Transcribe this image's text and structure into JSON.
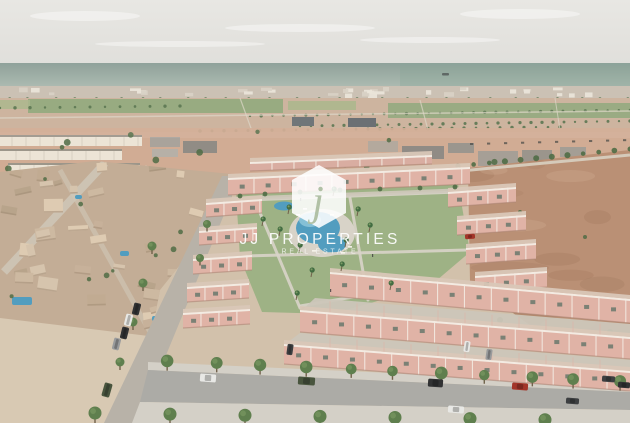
{
  "image": {
    "type": "aerial-3d-render",
    "description": "Aerial drone-style 3D render of a new-build residential development of salmon-pink villas arranged around a communal pool and landscaped gardens, next to an existing beige low-rise neighborhood on the left, a large empty dirt plot on the right, tree-lined streets with parked cars in the foreground, farm fields, a coastal town strip and the sea on the horizon under a hazy pale sky.",
    "width_px": 630,
    "height_px": 423
  },
  "watermark": {
    "brand": "JJ PROPERTIES",
    "tagline": "REAL ESTATE",
    "logo_glyph": "j",
    "logo_shape": "hexagon"
  },
  "scene": {
    "regions": [
      "sky",
      "sea",
      "ship",
      "coastal town",
      "farm fields",
      "distant buildings",
      "existing neighborhood",
      "private pools",
      "new development",
      "communal pool",
      "sun deck",
      "gardens",
      "palm trees",
      "empty dirt plot",
      "streets",
      "sidewalks",
      "street trees",
      "parked cars"
    ]
  },
  "palette": {
    "sky_top": "#e8e7e3",
    "sky_bottom": "#e0dfdb",
    "sea_top": "#8da099",
    "sea_bottom": "#adbbb1",
    "sea_teal": "#86a595",
    "ship": "#5c6562",
    "coast": "#c6bcae",
    "coast_building": "#e9e3d7",
    "coast_building_dark": "#d6cec0",
    "field_green": "#8ba374",
    "field_green2": "#a5b183",
    "dirt_far": "#c9ae97",
    "dirt_mid": "#d0a98f",
    "ground": "#d2c0aa",
    "sand": "#d8c8b2",
    "neighborhood": "#c2ac94",
    "neighborhood_houses": [
      "#cdb8a0",
      "#c0aa90",
      "#d6c3ac",
      "#b7a389",
      "#decab1",
      "#c6b098"
    ],
    "house_shadow": "#a08a72",
    "white_terrace": "#ece4d6",
    "terrace_roofline": "#9b9488",
    "villa": "#e0b2a5",
    "villa_back": "#d9aca0",
    "trim": "#f3ebe2",
    "roof_terrace": "#d9c6b6",
    "window": "#66756a",
    "wall_shadow": "#a8806f",
    "lawn": "#9db183",
    "path": "#d9d4c8",
    "deck": "#d8d3c7",
    "pool": "#4f9cbe",
    "pool_light": "#8cc6da",
    "palm": "#3f6b3f",
    "tree": "#4c6a42",
    "tree_street": "#5c7d4b",
    "tree_light": "#82a065",
    "trunk": "#6f5f48",
    "dirt_lot": "#b98e73",
    "dirt_lot_dark": "#9c7258",
    "dirt_lot_light": "#d2ab92",
    "road": "#abaaa5",
    "road_branch": "#b7b1a7",
    "sidewalk": "#d4d0c6",
    "driveway": "#cbc5b8",
    "dirt_road_line": "#dcd4c4",
    "car_white": "#e8e8e5",
    "car_green": "#46523b",
    "car_black": "#2d2e2f",
    "car_red": "#a23125",
    "car_gray": "#97999b",
    "car_dark": "#3a3c3e",
    "figure": "#3c3c3c",
    "watermark_white": "#ffffff",
    "logo_glyph_green": "#aebfa2"
  }
}
